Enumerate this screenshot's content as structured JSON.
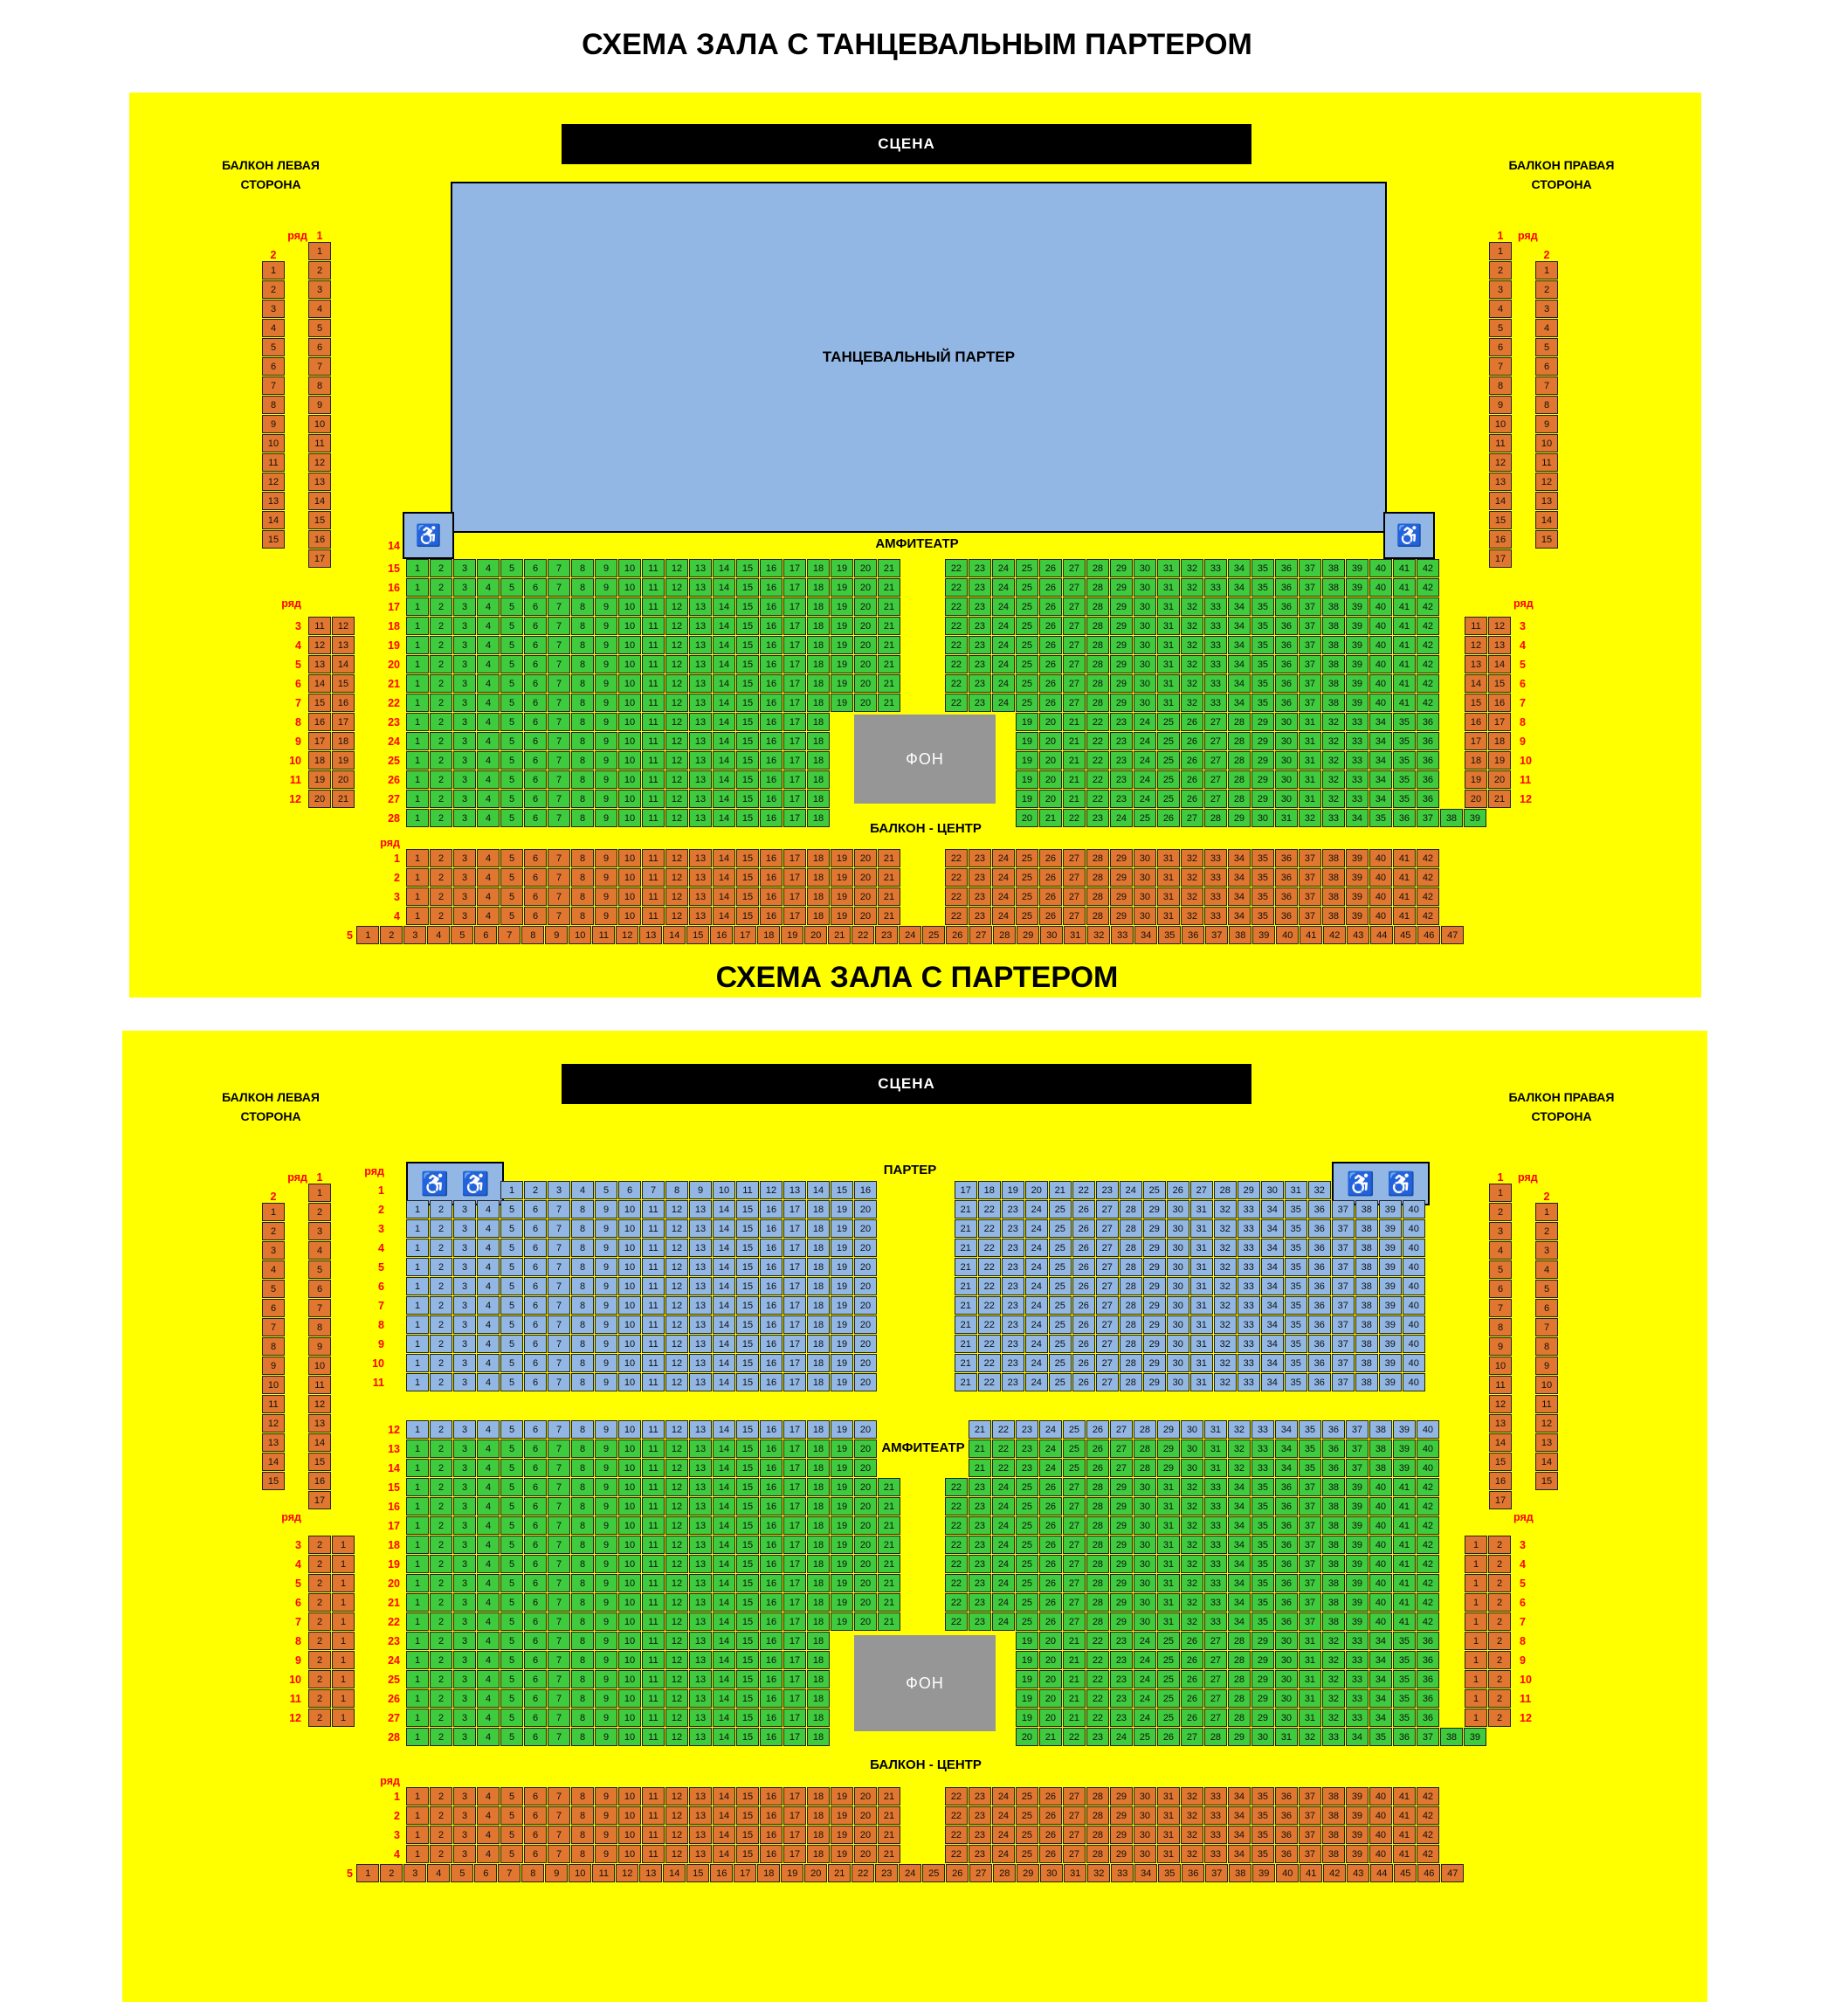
{
  "labels": {
    "stage": "СЦЕНА",
    "dance_floor": "ТАНЦЕВАЛЬНЫЙ ПАРТЕР",
    "amphitheatre": "АМФИТЕАТР",
    "parterre": "ПАРТЕР",
    "fon": "ФОН",
    "balcony_center": "БАЛКОН - ЦЕНТР",
    "balcony_left_line1": "БАЛКОН ЛЕВАЯ",
    "balcony_left_line2": "СТОРОНА",
    "balcony_right_line1": "БАЛКОН ПРАВАЯ",
    "balcony_right_line2": "СТОРОНА",
    "row_word": "ряд",
    "wheelchair_icon": "♿"
  },
  "colors": {
    "panel": "#ffff00",
    "seat_green": "#3ecb3e",
    "seat_orange": "#e0762f",
    "seat_blue": "#92b7e4",
    "stage_bg": "#000000",
    "fon_bg": "#969696",
    "row_label": "#ff0000"
  },
  "diagram1": {
    "title": "СХЕМА ЗАЛА С ТАНЦЕВАЛЬНЫМ ПАРТЕРОМ",
    "balcony_columns": {
      "left": {
        "col1": {
          "label": "1",
          "from": 1,
          "to": 17
        },
        "col2": {
          "label": "2",
          "from": 1,
          "to": 15
        }
      },
      "right": {
        "col1": {
          "label": "1",
          "from": 1,
          "to": 17
        },
        "col2": {
          "label": "2",
          "from": 1,
          "to": 15
        }
      }
    },
    "side_pairs": {
      "rows": [
        {
          "row": 3,
          "seats": [
            11,
            12
          ]
        },
        {
          "row": 4,
          "seats": [
            12,
            13
          ]
        },
        {
          "row": 5,
          "seats": [
            13,
            14
          ]
        },
        {
          "row": 6,
          "seats": [
            14,
            15
          ]
        },
        {
          "row": 7,
          "seats": [
            15,
            16
          ]
        },
        {
          "row": 8,
          "seats": [
            16,
            17
          ]
        },
        {
          "row": 9,
          "seats": [
            17,
            18
          ]
        },
        {
          "row": 10,
          "seats": [
            18,
            19
          ]
        },
        {
          "row": 11,
          "seats": [
            19,
            20
          ]
        },
        {
          "row": 12,
          "seats": [
            20,
            21
          ]
        }
      ]
    },
    "amphitheatre": {
      "wheelchair_row_label": "14",
      "rows": [
        {
          "row": 15,
          "blocks": [
            {
              "u": 0,
              "from": 1,
              "to": 21
            },
            {
              "u": 22.85,
              "from": 22,
              "to": 42
            }
          ]
        },
        {
          "row": 16,
          "blocks": [
            {
              "u": 0,
              "from": 1,
              "to": 21
            },
            {
              "u": 22.85,
              "from": 22,
              "to": 42
            }
          ]
        },
        {
          "row": 17,
          "blocks": [
            {
              "u": 0,
              "from": 1,
              "to": 21
            },
            {
              "u": 22.85,
              "from": 22,
              "to": 42
            }
          ]
        },
        {
          "row": 18,
          "blocks": [
            {
              "u": 0,
              "from": 1,
              "to": 21
            },
            {
              "u": 22.85,
              "from": 22,
              "to": 42
            }
          ]
        },
        {
          "row": 19,
          "blocks": [
            {
              "u": 0,
              "from": 1,
              "to": 21
            },
            {
              "u": 22.85,
              "from": 22,
              "to": 42
            }
          ]
        },
        {
          "row": 20,
          "blocks": [
            {
              "u": 0,
              "from": 1,
              "to": 21
            },
            {
              "u": 22.85,
              "from": 22,
              "to": 42
            }
          ]
        },
        {
          "row": 21,
          "blocks": [
            {
              "u": 0,
              "from": 1,
              "to": 21
            },
            {
              "u": 22.85,
              "from": 22,
              "to": 42
            }
          ]
        },
        {
          "row": 22,
          "blocks": [
            {
              "u": 0,
              "from": 1,
              "to": 21
            },
            {
              "u": 22.85,
              "from": 22,
              "to": 42
            }
          ]
        },
        {
          "row": 23,
          "blocks": [
            {
              "u": 0,
              "from": 1,
              "to": 18
            },
            {
              "u": 25.85,
              "from": 19,
              "to": 36
            }
          ]
        },
        {
          "row": 24,
          "blocks": [
            {
              "u": 0,
              "from": 1,
              "to": 18
            },
            {
              "u": 25.85,
              "from": 19,
              "to": 36
            }
          ]
        },
        {
          "row": 25,
          "blocks": [
            {
              "u": 0,
              "from": 1,
              "to": 18
            },
            {
              "u": 25.85,
              "from": 19,
              "to": 36
            }
          ]
        },
        {
          "row": 26,
          "blocks": [
            {
              "u": 0,
              "from": 1,
              "to": 18
            },
            {
              "u": 25.85,
              "from": 19,
              "to": 36
            }
          ]
        },
        {
          "row": 27,
          "blocks": [
            {
              "u": 0,
              "from": 1,
              "to": 18
            },
            {
              "u": 25.85,
              "from": 19,
              "to": 36
            }
          ]
        },
        {
          "row": 28,
          "blocks": [
            {
              "u": 0,
              "from": 1,
              "to": 18
            },
            {
              "u": 25.85,
              "from": 20,
              "to": 39
            }
          ]
        }
      ]
    },
    "balcony_center": {
      "rows": [
        {
          "row": 1,
          "blocks": [
            {
              "u": 0,
              "from": 1,
              "to": 21
            },
            {
              "u": 22.85,
              "from": 22,
              "to": 42
            }
          ]
        },
        {
          "row": 2,
          "blocks": [
            {
              "u": 0,
              "from": 1,
              "to": 21
            },
            {
              "u": 22.85,
              "from": 22,
              "to": 42
            }
          ]
        },
        {
          "row": 3,
          "blocks": [
            {
              "u": 0,
              "from": 1,
              "to": 21
            },
            {
              "u": 22.85,
              "from": 22,
              "to": 42
            }
          ]
        },
        {
          "row": 4,
          "blocks": [
            {
              "u": 0,
              "from": 1,
              "to": 21
            },
            {
              "u": 22.85,
              "from": 22,
              "to": 42
            }
          ]
        },
        {
          "row": 5,
          "blocks": [
            {
              "u": -2.1,
              "from": 1,
              "to": 47
            }
          ]
        }
      ]
    }
  },
  "diagram2": {
    "title": "СХЕМА ЗАЛА С ПАРТЕРОМ",
    "balcony_columns": {
      "left": {
        "col1": {
          "label": "1",
          "from": 1,
          "to": 17
        },
        "col2": {
          "label": "2",
          "from": 1,
          "to": 15
        }
      },
      "right": {
        "col1": {
          "label": "1",
          "from": 1,
          "to": 17
        },
        "col2": {
          "label": "2",
          "from": 1,
          "to": 15
        }
      }
    },
    "parterre": {
      "rows": [
        {
          "row": 1,
          "wheelchair_left": true,
          "wheelchair_right": true,
          "blocks": [
            {
              "u": 4,
              "from": 1,
              "to": 16
            },
            {
              "u": 23.25,
              "from": 17,
              "to": 32
            }
          ]
        },
        {
          "row": 2,
          "blocks": [
            {
              "u": 0,
              "from": 1,
              "to": 20
            },
            {
              "u": 23.25,
              "from": 21,
              "to": 40
            }
          ]
        },
        {
          "row": 3,
          "blocks": [
            {
              "u": 0,
              "from": 1,
              "to": 20
            },
            {
              "u": 23.25,
              "from": 21,
              "to": 40
            }
          ]
        },
        {
          "row": 4,
          "blocks": [
            {
              "u": 0,
              "from": 1,
              "to": 20
            },
            {
              "u": 23.25,
              "from": 21,
              "to": 40
            }
          ]
        },
        {
          "row": 5,
          "blocks": [
            {
              "u": 0,
              "from": 1,
              "to": 20
            },
            {
              "u": 23.25,
              "from": 21,
              "to": 40
            }
          ]
        },
        {
          "row": 6,
          "blocks": [
            {
              "u": 0,
              "from": 1,
              "to": 20
            },
            {
              "u": 23.25,
              "from": 21,
              "to": 40
            }
          ]
        },
        {
          "row": 7,
          "blocks": [
            {
              "u": 0,
              "from": 1,
              "to": 20
            },
            {
              "u": 23.25,
              "from": 21,
              "to": 40
            }
          ]
        },
        {
          "row": 8,
          "blocks": [
            {
              "u": 0,
              "from": 1,
              "to": 20
            },
            {
              "u": 23.25,
              "from": 21,
              "to": 40
            }
          ]
        },
        {
          "row": 9,
          "blocks": [
            {
              "u": 0,
              "from": 1,
              "to": 20
            },
            {
              "u": 23.25,
              "from": 21,
              "to": 40
            }
          ]
        },
        {
          "row": 10,
          "blocks": [
            {
              "u": 0,
              "from": 1,
              "to": 20
            },
            {
              "u": 23.25,
              "from": 21,
              "to": 40
            }
          ]
        },
        {
          "row": 11,
          "blocks": [
            {
              "u": 0,
              "from": 1,
              "to": 20
            },
            {
              "u": 23.25,
              "from": 21,
              "to": 40
            }
          ]
        }
      ]
    },
    "side_pairs": {
      "left_rows": [
        {
          "row": 3,
          "seats": [
            2,
            1
          ]
        },
        {
          "row": 4,
          "seats": [
            2,
            1
          ]
        },
        {
          "row": 5,
          "seats": [
            2,
            1
          ]
        },
        {
          "row": 6,
          "seats": [
            2,
            1
          ]
        },
        {
          "row": 7,
          "seats": [
            2,
            1
          ]
        },
        {
          "row": 8,
          "seats": [
            2,
            1
          ]
        },
        {
          "row": 9,
          "seats": [
            2,
            1
          ]
        },
        {
          "row": 10,
          "seats": [
            2,
            1
          ]
        },
        {
          "row": 11,
          "seats": [
            2,
            1
          ]
        },
        {
          "row": 12,
          "seats": [
            2,
            1
          ]
        }
      ],
      "right_rows": [
        {
          "row": 3,
          "seats": [
            1,
            2
          ]
        },
        {
          "row": 4,
          "seats": [
            1,
            2
          ]
        },
        {
          "row": 5,
          "seats": [
            1,
            2
          ]
        },
        {
          "row": 6,
          "seats": [
            1,
            2
          ]
        },
        {
          "row": 7,
          "seats": [
            1,
            2
          ]
        },
        {
          "row": 8,
          "seats": [
            1,
            2
          ]
        },
        {
          "row": 9,
          "seats": [
            1,
            2
          ]
        },
        {
          "row": 10,
          "seats": [
            1,
            2
          ]
        },
        {
          "row": 11,
          "seats": [
            1,
            2
          ]
        },
        {
          "row": 12,
          "seats": [
            1,
            2
          ]
        }
      ]
    },
    "amphitheatre": {
      "rows": [
        {
          "row": 12,
          "color": "blue",
          "blocks": [
            {
              "u": 0,
              "from": 1,
              "to": 20
            },
            {
              "u": 23.85,
              "from": 21,
              "to": 40
            }
          ]
        },
        {
          "row": 13,
          "section_label": true,
          "blocks": [
            {
              "u": 0,
              "from": 1,
              "to": 20
            },
            {
              "u": 23.85,
              "from": 21,
              "to": 40
            }
          ]
        },
        {
          "row": 14,
          "blocks": [
            {
              "u": 0,
              "from": 1,
              "to": 20
            },
            {
              "u": 23.85,
              "from": 21,
              "to": 40
            }
          ]
        },
        {
          "row": 15,
          "blocks": [
            {
              "u": 0,
              "from": 1,
              "to": 21
            },
            {
              "u": 22.85,
              "from": 22,
              "to": 42
            }
          ]
        },
        {
          "row": 16,
          "blocks": [
            {
              "u": 0,
              "from": 1,
              "to": 21
            },
            {
              "u": 22.85,
              "from": 22,
              "to": 42
            }
          ]
        },
        {
          "row": 17,
          "blocks": [
            {
              "u": 0,
              "from": 1,
              "to": 21
            },
            {
              "u": 22.85,
              "from": 22,
              "to": 42
            }
          ]
        },
        {
          "row": 18,
          "blocks": [
            {
              "u": 0,
              "from": 1,
              "to": 21
            },
            {
              "u": 22.85,
              "from": 22,
              "to": 42
            }
          ]
        },
        {
          "row": 19,
          "blocks": [
            {
              "u": 0,
              "from": 1,
              "to": 21
            },
            {
              "u": 22.85,
              "from": 22,
              "to": 42
            }
          ]
        },
        {
          "row": 20,
          "blocks": [
            {
              "u": 0,
              "from": 1,
              "to": 21
            },
            {
              "u": 22.85,
              "from": 22,
              "to": 42
            }
          ]
        },
        {
          "row": 21,
          "blocks": [
            {
              "u": 0,
              "from": 1,
              "to": 21
            },
            {
              "u": 22.85,
              "from": 22,
              "to": 42
            }
          ]
        },
        {
          "row": 22,
          "blocks": [
            {
              "u": 0,
              "from": 1,
              "to": 21
            },
            {
              "u": 22.85,
              "from": 22,
              "to": 42
            }
          ]
        },
        {
          "row": 23,
          "blocks": [
            {
              "u": 0,
              "from": 1,
              "to": 18
            },
            {
              "u": 25.85,
              "from": 19,
              "to": 36
            }
          ]
        },
        {
          "row": 24,
          "blocks": [
            {
              "u": 0,
              "from": 1,
              "to": 18
            },
            {
              "u": 25.85,
              "from": 19,
              "to": 36
            }
          ]
        },
        {
          "row": 25,
          "blocks": [
            {
              "u": 0,
              "from": 1,
              "to": 18
            },
            {
              "u": 25.85,
              "from": 19,
              "to": 36
            }
          ]
        },
        {
          "row": 26,
          "blocks": [
            {
              "u": 0,
              "from": 1,
              "to": 18
            },
            {
              "u": 25.85,
              "from": 19,
              "to": 36
            }
          ]
        },
        {
          "row": 27,
          "blocks": [
            {
              "u": 0,
              "from": 1,
              "to": 18
            },
            {
              "u": 25.85,
              "from": 19,
              "to": 36
            }
          ]
        },
        {
          "row": 28,
          "blocks": [
            {
              "u": 0,
              "from": 1,
              "to": 18
            },
            {
              "u": 25.85,
              "from": 20,
              "to": 39
            }
          ]
        }
      ]
    },
    "balcony_center": {
      "rows": [
        {
          "row": 1,
          "blocks": [
            {
              "u": 0,
              "from": 1,
              "to": 21
            },
            {
              "u": 22.85,
              "from": 22,
              "to": 42
            }
          ]
        },
        {
          "row": 2,
          "blocks": [
            {
              "u": 0,
              "from": 1,
              "to": 21
            },
            {
              "u": 22.85,
              "from": 22,
              "to": 42
            }
          ]
        },
        {
          "row": 3,
          "blocks": [
            {
              "u": 0,
              "from": 1,
              "to": 21
            },
            {
              "u": 22.85,
              "from": 22,
              "to": 42
            }
          ]
        },
        {
          "row": 4,
          "blocks": [
            {
              "u": 0,
              "from": 1,
              "to": 21
            },
            {
              "u": 22.85,
              "from": 22,
              "to": 42
            }
          ]
        },
        {
          "row": 5,
          "blocks": [
            {
              "u": -2.1,
              "from": 1,
              "to": 47
            }
          ]
        }
      ]
    }
  }
}
